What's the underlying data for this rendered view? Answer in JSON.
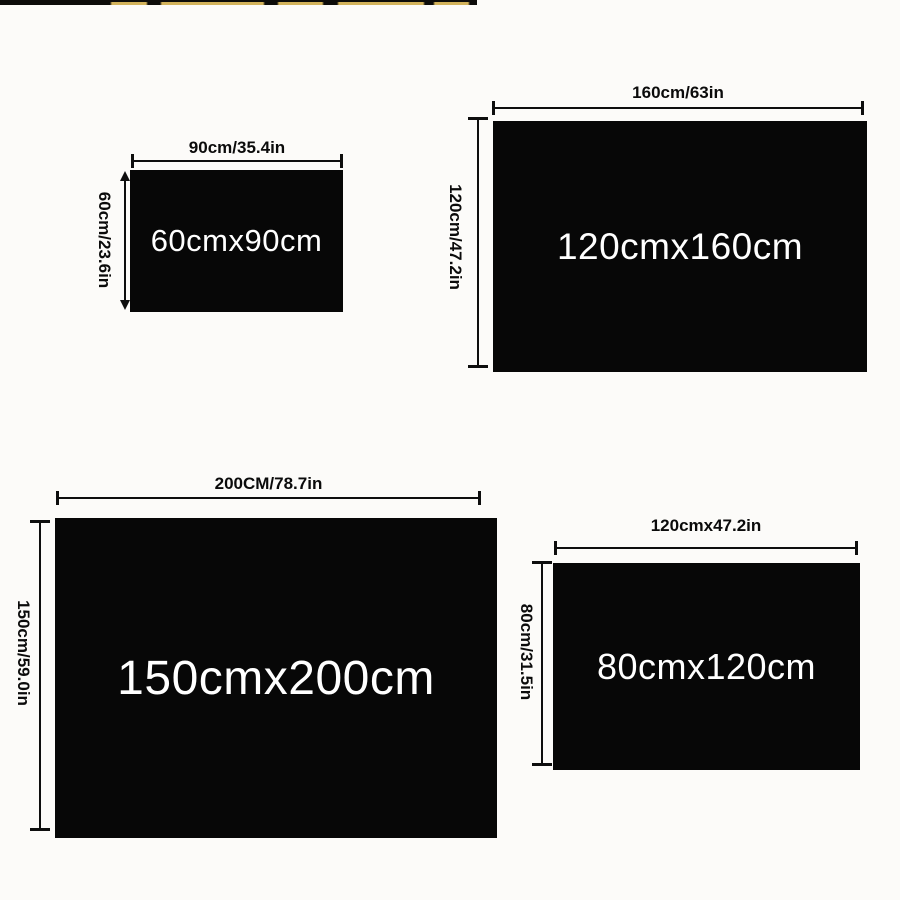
{
  "image_type": "product-size-chart",
  "colors": {
    "background": "#fcfbf9",
    "rect_fill": "#070707",
    "line_color": "#0e0e0e",
    "size_text_color": "#ffffff",
    "label_text_color": "#0b0b0b",
    "strip_gold": "#d3b35c",
    "strip_black": "#0d0c0a"
  },
  "panels": [
    {
      "id": "60x90",
      "width_label": "90cm/35.4in",
      "height_label": "60cm/23.6in",
      "size_label": "60cmx90cm"
    },
    {
      "id": "120x160",
      "width_label": "160cm/63in",
      "height_label": "120cm/47.2in",
      "size_label": "120cmx160cm"
    },
    {
      "id": "150x200",
      "width_label": "200CM/78.7in",
      "height_label": "150cm/59.0in",
      "size_label": "150cmx200cm"
    },
    {
      "id": "80x120",
      "width_label": "120cmx47.2in",
      "height_label": "80cm/31.5in",
      "size_label": "80cmx120cm"
    }
  ]
}
